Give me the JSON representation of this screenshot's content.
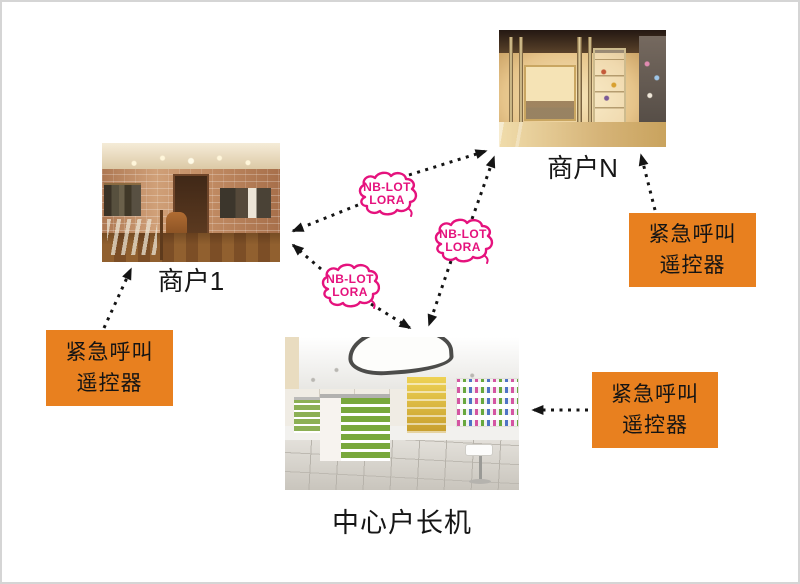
{
  "colors": {
    "box_orange": "#E8801F",
    "cloud_pink": "#E5127D",
    "arrow_black": "#141414",
    "page_border": "#d5d5d5"
  },
  "nodes": {
    "store1": {
      "label": "商户1",
      "type": "photo-menswear-shop"
    },
    "storeN": {
      "label": "商户N",
      "type": "photo-boutique-storefront"
    },
    "central": {
      "label": "中心户长机",
      "type": "photo-cosmetics-store"
    }
  },
  "remote_box": {
    "line1": "紧急呼叫",
    "line2": "遥控器"
  },
  "cloud_label": {
    "line1": "NB-LOT",
    "line2": "LORA"
  },
  "links": [
    {
      "from": "store1",
      "to": "storeN",
      "via": "NB-LOT LORA",
      "bidirectional": true
    },
    {
      "from": "store1",
      "to": "central",
      "via": "NB-LOT LORA",
      "bidirectional": true
    },
    {
      "from": "central",
      "to": "storeN",
      "via": "NB-LOT LORA",
      "bidirectional": true
    },
    {
      "from": "remote-left",
      "to": "store1",
      "bidirectional": false
    },
    {
      "from": "remote-top-right",
      "to": "storeN",
      "bidirectional": false
    },
    {
      "from": "remote-bottom-right",
      "to": "central",
      "bidirectional": false
    }
  ]
}
